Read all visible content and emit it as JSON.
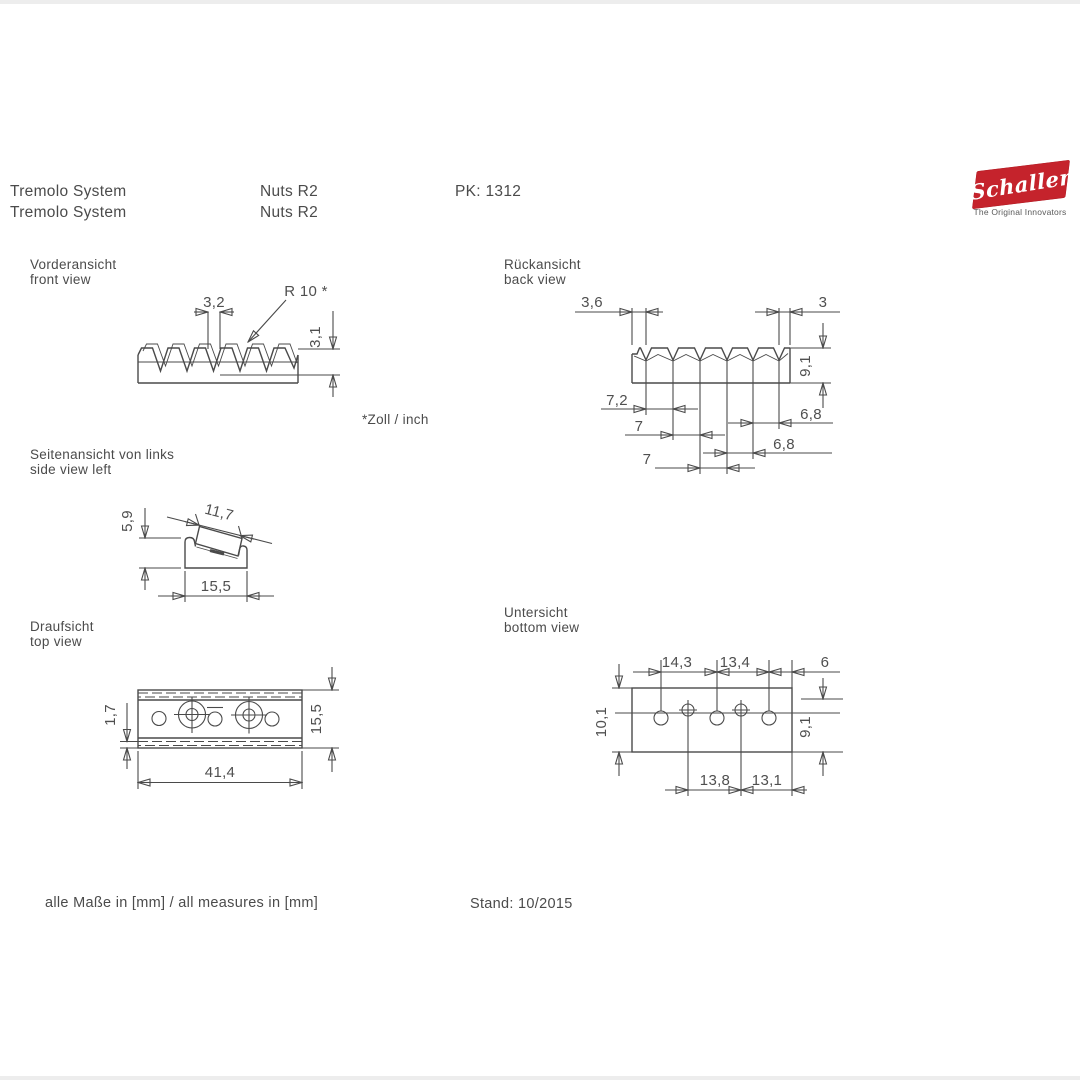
{
  "colors": {
    "line": "#4a4a4a",
    "text": "#4b4b4b",
    "logo_red": "#c5232c"
  },
  "header": {
    "row1": {
      "product": "Tremolo System",
      "model": "Nuts R2",
      "pk": "PK: 1312"
    },
    "row2": {
      "product": "Tremolo System",
      "model": "Nuts R2"
    }
  },
  "logo": {
    "brand": "Schaller",
    "tagline": "The Original Innovators"
  },
  "views": {
    "front": {
      "title_de": "Vorderansicht",
      "title_en": "front view",
      "dim_slot_width": "3,2",
      "dim_radius": "R 10 *",
      "dim_depth": "3,1",
      "footnote": "*Zoll / inch"
    },
    "back": {
      "title_de": "Rückansicht",
      "title_en": "back view",
      "dim_left_edge": "3,6",
      "dim_right_edge": "3",
      "dim_height": "9,1",
      "dim_pitch_1": "7,2",
      "dim_pitch_2": "7",
      "dim_pitch_3": "7",
      "dim_pitch_4": "6,8",
      "dim_pitch_5": "6,8"
    },
    "side": {
      "title_de": "Seitenansicht von links",
      "title_en": "side view left",
      "dim_height": "5,9",
      "dim_top_length": "11,7",
      "dim_base_width": "15,5"
    },
    "top": {
      "title_de": "Draufsicht",
      "title_en": "top view",
      "dim_edge": "1,7",
      "dim_depth": "15,5",
      "dim_width": "41,4"
    },
    "bottom": {
      "title_de": "Untersicht",
      "title_en": "bottom view",
      "dim_hole_pitch_1": "14,3",
      "dim_hole_pitch_2": "13,4",
      "dim_edge_offset": "6",
      "dim_depth_left": "10,1",
      "dim_depth_right": "9,1",
      "dim_screw_pitch_1": "13,8",
      "dim_screw_pitch_2": "13,1"
    }
  },
  "footer": {
    "note": "alle Maße in [mm] / all measures in [mm]",
    "stand": "Stand: 10/2015"
  }
}
